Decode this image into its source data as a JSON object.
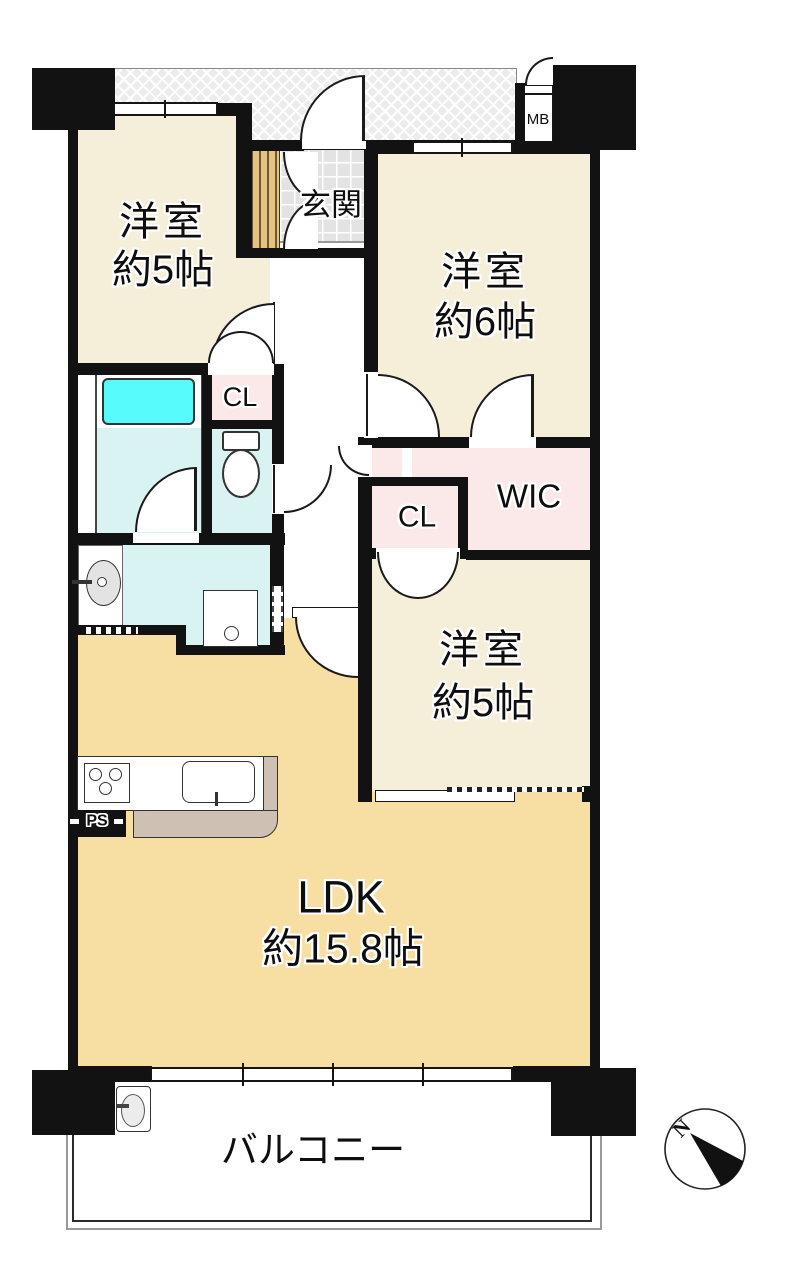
{
  "plan": {
    "rooms": {
      "western_room_top_left": {
        "label_line1": "洋室",
        "label_line2": "約5帖"
      },
      "western_room_top_right": {
        "label_line1": "洋室",
        "label_line2": "約6帖"
      },
      "western_room_middle": {
        "label_line1": "洋室",
        "label_line2": "約5帖"
      },
      "ldk": {
        "label_line1": "LDK",
        "label_line2": "約15.8帖"
      },
      "entrance": {
        "label": "玄関"
      },
      "balcony": {
        "label": "バルコニー"
      },
      "closet_by_bathroom": {
        "label": "CL"
      },
      "closet_middle": {
        "label": "CL"
      },
      "walk_in_closet": {
        "label": "WIC"
      },
      "meter_box": {
        "label": "MB"
      },
      "pipe_space": {
        "label": "PS"
      }
    },
    "compass": {
      "north_label": "N"
    },
    "colors": {
      "wall_black": "#121212",
      "room_cream": "#f5eed9",
      "ldk_tan": "#f7dfa4",
      "closet_pink": "#fbe9e9",
      "wet_area_cyan": "#d9f3f2",
      "bathtub_cyan": "#57fbfb",
      "wood_slat_tan": "#e3c37f",
      "counter_edge_tan": "#cec0b3",
      "hatch_gray": "#ececec",
      "tile_gray": "#e3e3e3"
    }
  }
}
